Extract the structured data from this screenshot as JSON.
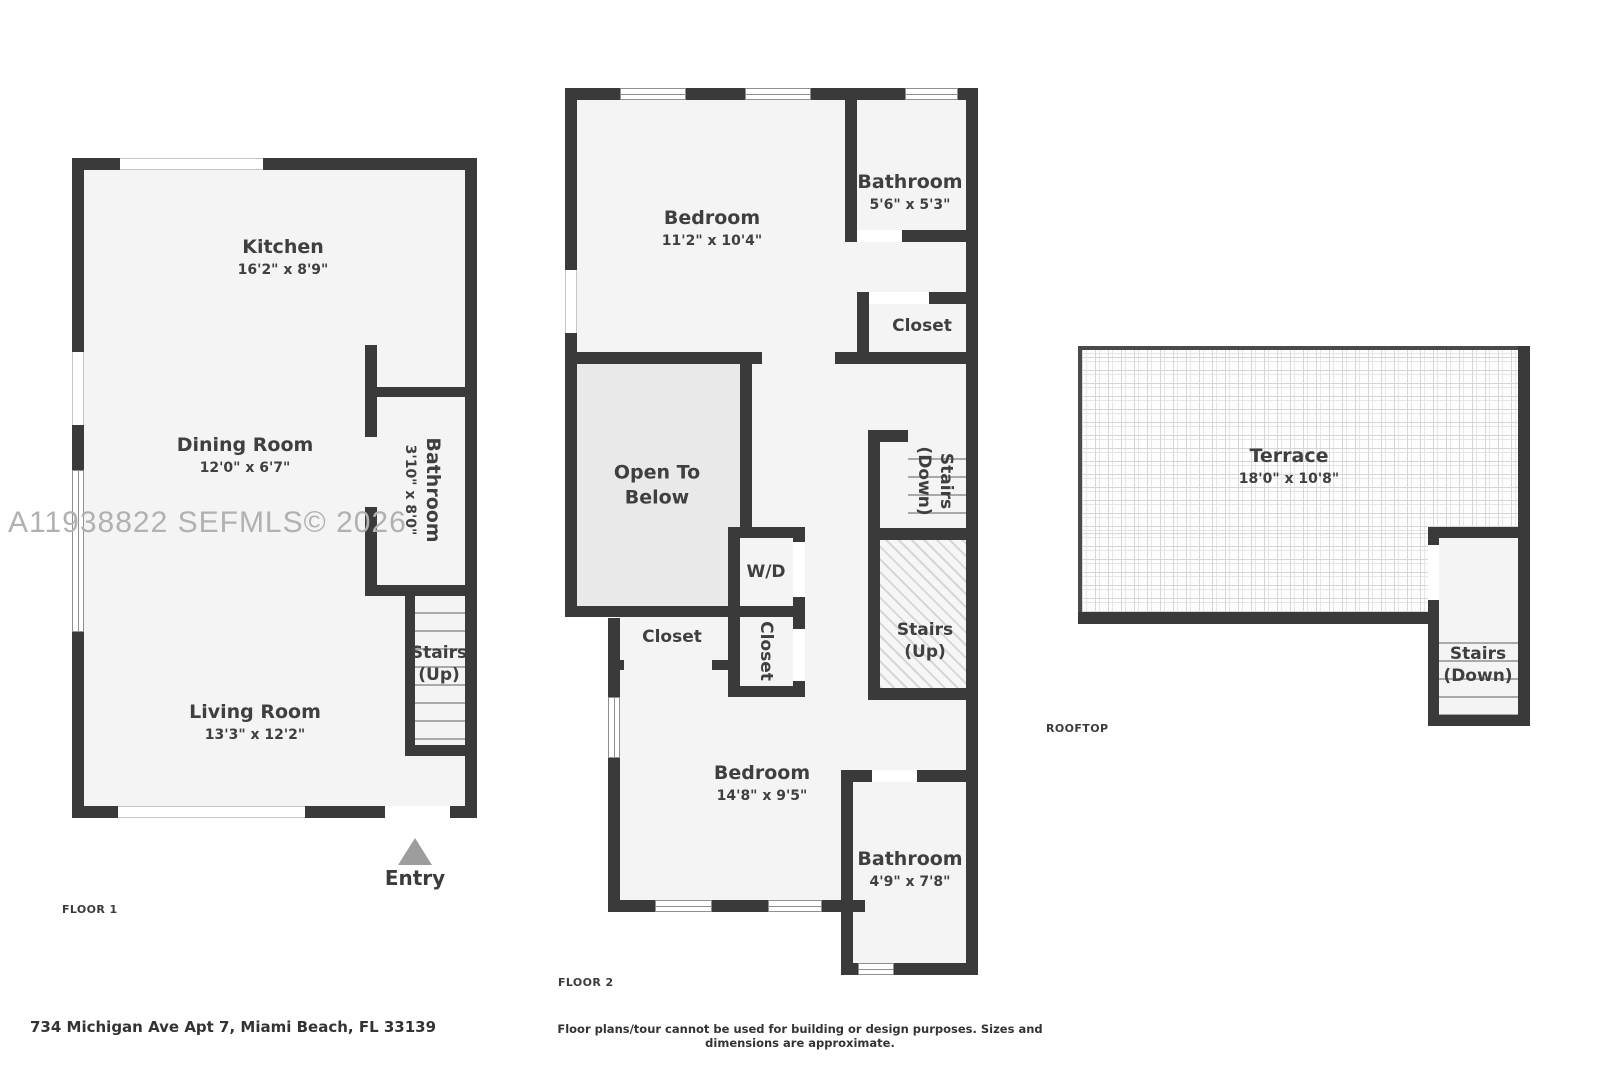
{
  "watermark": "A11938822  SEFMLS© 2026",
  "address": "734 Michigan Ave Apt 7, Miami Beach, FL 33139",
  "disclaimer": "Floor plans/tour cannot be used for building or design purposes. Sizes and dimensions are approximate.",
  "colors": {
    "wall": "#3a3a3a",
    "room_fill": "#f4f4f4",
    "open_to_below_fill": "#e9e9e9",
    "label_text": "#3f3f3f",
    "watermark": "#b1b1b1",
    "entry_arrow": "#9d9d9d"
  },
  "floor1": {
    "label": "FLOOR 1",
    "kitchen": {
      "name": "Kitchen",
      "dims": "16'2\" x 8'9\""
    },
    "dining": {
      "name": "Dining Room",
      "dims": "12'0\" x 6'7\""
    },
    "bathroom": {
      "name": "Bathroom",
      "dims": "3'10\" x 8'0\""
    },
    "living": {
      "name": "Living Room",
      "dims": "13'3\" x 12'2\""
    },
    "stairs_up": "Stairs\n(Up)",
    "entry": "Entry"
  },
  "floor2": {
    "label": "FLOOR 2",
    "bedroom_top": {
      "name": "Bedroom",
      "dims": "11'2\" x 10'4\""
    },
    "bathroom_top": {
      "name": "Bathroom",
      "dims": "5'6\" x 5'3\""
    },
    "closet_right": "Closet",
    "open_to_below": "Open To\nBelow",
    "wd": "W/D",
    "stairs_down": "Stairs\n(Down)",
    "stairs_up": "Stairs\n(Up)",
    "closet_left": "Closet",
    "closet_mid": "Closet",
    "bedroom_bottom": {
      "name": "Bedroom",
      "dims": "14'8\" x 9'5\""
    },
    "bathroom_bottom": {
      "name": "Bathroom",
      "dims": "4'9\" x 7'8\""
    }
  },
  "rooftop": {
    "label": "ROOFTOP",
    "terrace": {
      "name": "Terrace",
      "dims": "18'0\" x 10'8\""
    },
    "stairs_down": "Stairs\n(Down)"
  }
}
